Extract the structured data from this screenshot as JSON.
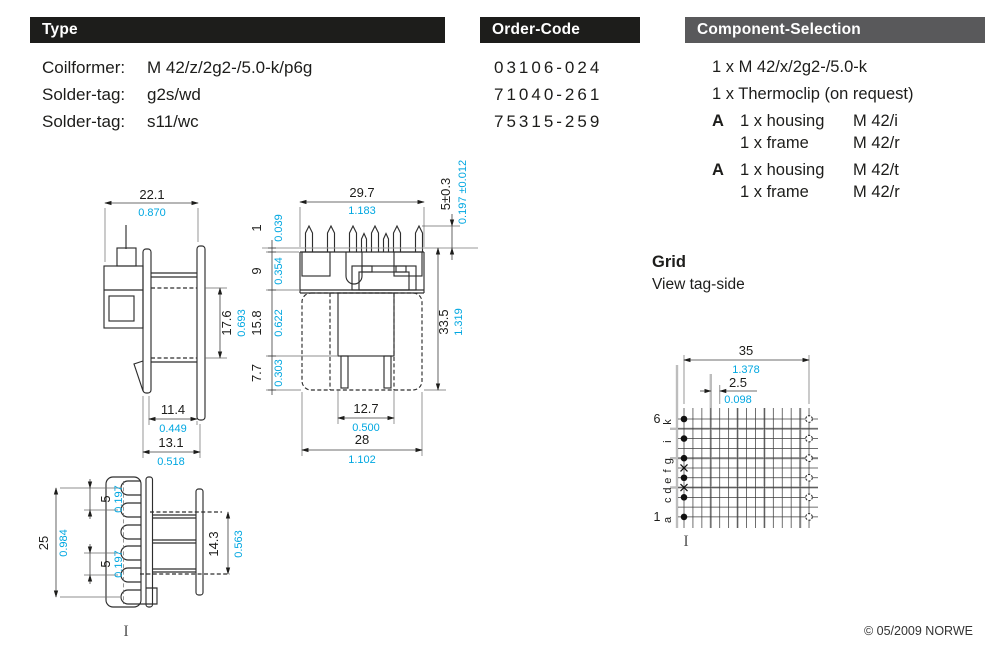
{
  "page": {
    "copyright": "© 05/2009 NORWE"
  },
  "colors": {
    "bar_black": "#1d1d1b",
    "bar_gray": "#59595b",
    "accent_cyan": "#00a7e1"
  },
  "headers": {
    "type": "Type",
    "order_code": "Order-Code",
    "component_selection": "Component-Selection"
  },
  "type_section": {
    "rows": [
      {
        "label": "Coilformer:",
        "value": "M 42/z/2g2-/5.0-k/p6g"
      },
      {
        "label": "Solder-tag:",
        "value": "g2s/wd"
      },
      {
        "label": "Solder-tag:",
        "value": "s11/wc"
      }
    ]
  },
  "order_codes": [
    "03106-024",
    "71040-261",
    "75315-259"
  ],
  "component_selection": {
    "items": [
      "1 x M 42/x/2g2-/5.0-k",
      "1 x Thermoclip (on request)"
    ],
    "groups": [
      {
        "marker": "A",
        "rows": [
          {
            "qty": "1 x housing",
            "part": "M 42/i"
          },
          {
            "qty": "1 x frame",
            "part": "M 42/r"
          }
        ]
      },
      {
        "marker": "A",
        "rows": [
          {
            "qty": "1 x housing",
            "part": "M 42/t"
          },
          {
            "qty": "1 x frame",
            "part": "M 42/r"
          }
        ]
      }
    ]
  },
  "grid_section": {
    "title": "Grid",
    "subtitle": "View tag-side"
  },
  "dims": {
    "side": {
      "w_mm": "22.1",
      "w_in": "0.870",
      "win_mm": "17.6",
      "win_in": "0.693",
      "b1_mm": "11.4",
      "b1_in": "0.449",
      "b2_mm": "13.1",
      "b2_in": "0.518"
    },
    "front": {
      "w_mm": "29.7",
      "w_in": "1.183",
      "pin_mm": "5±0.3",
      "pin_in": "0.197 ±0.012",
      "s1_mm": "1",
      "s1_in": "0.039",
      "s2_mm": "9",
      "s2_in": "0.354",
      "s3_mm": "15.8",
      "s3_in": "0.622",
      "s4_mm": "7.7",
      "s4_in": "0.303",
      "h_mm": "33.5",
      "h_in": "1.319",
      "wi_mm": "12.7",
      "wi_in": "0.500",
      "wb_mm": "28",
      "wb_in": "1.102"
    },
    "end": {
      "h_mm": "25",
      "h_in": "0.984",
      "p1_mm": "5",
      "p1_in": "0.197",
      "p2_mm": "5",
      "p2_in": "0.197",
      "d_mm": "14.3",
      "d_in": "0.563",
      "marker": "I"
    },
    "grid": {
      "w_mm": "35",
      "w_in": "1.378",
      "p_mm": "2.5",
      "p_in": "0.098",
      "num_top": "6",
      "num_bottom": "1",
      "letters": [
        "k",
        "i",
        "g",
        "f",
        "e",
        "d",
        "c",
        "a"
      ],
      "marker": "I"
    }
  },
  "grid_view": {
    "spec": {
      "cols": 15,
      "rows": 11,
      "x0": 684,
      "y0": 419,
      "dx": 8.93,
      "dy": 9.79,
      "vy1": 408,
      "vy2": 528,
      "hx1": 678,
      "hx2": 818,
      "dot_rows": [
        0,
        2,
        4,
        6,
        8,
        10
      ],
      "x_rows": [
        5,
        7
      ],
      "gray_v": [
        {
          "x": 677,
          "y1": 365,
          "y2": 528
        },
        {
          "x": 710.8,
          "y1": 374,
          "y2": 528
        },
        {
          "x": 737.6,
          "y1": 408,
          "y2": 528
        },
        {
          "x": 764.4,
          "y1": 408,
          "y2": 528
        },
        {
          "x": 800.2,
          "y1": 408,
          "y2": 528
        }
      ],
      "gray_h": [
        {
          "y": 428.8,
          "x1": 670,
          "x2": 818
        },
        {
          "y": 458.2,
          "x1": 670,
          "x2": 818
        },
        {
          "y": 487.5,
          "x1": 670,
          "x2": 818
        }
      ]
    }
  }
}
